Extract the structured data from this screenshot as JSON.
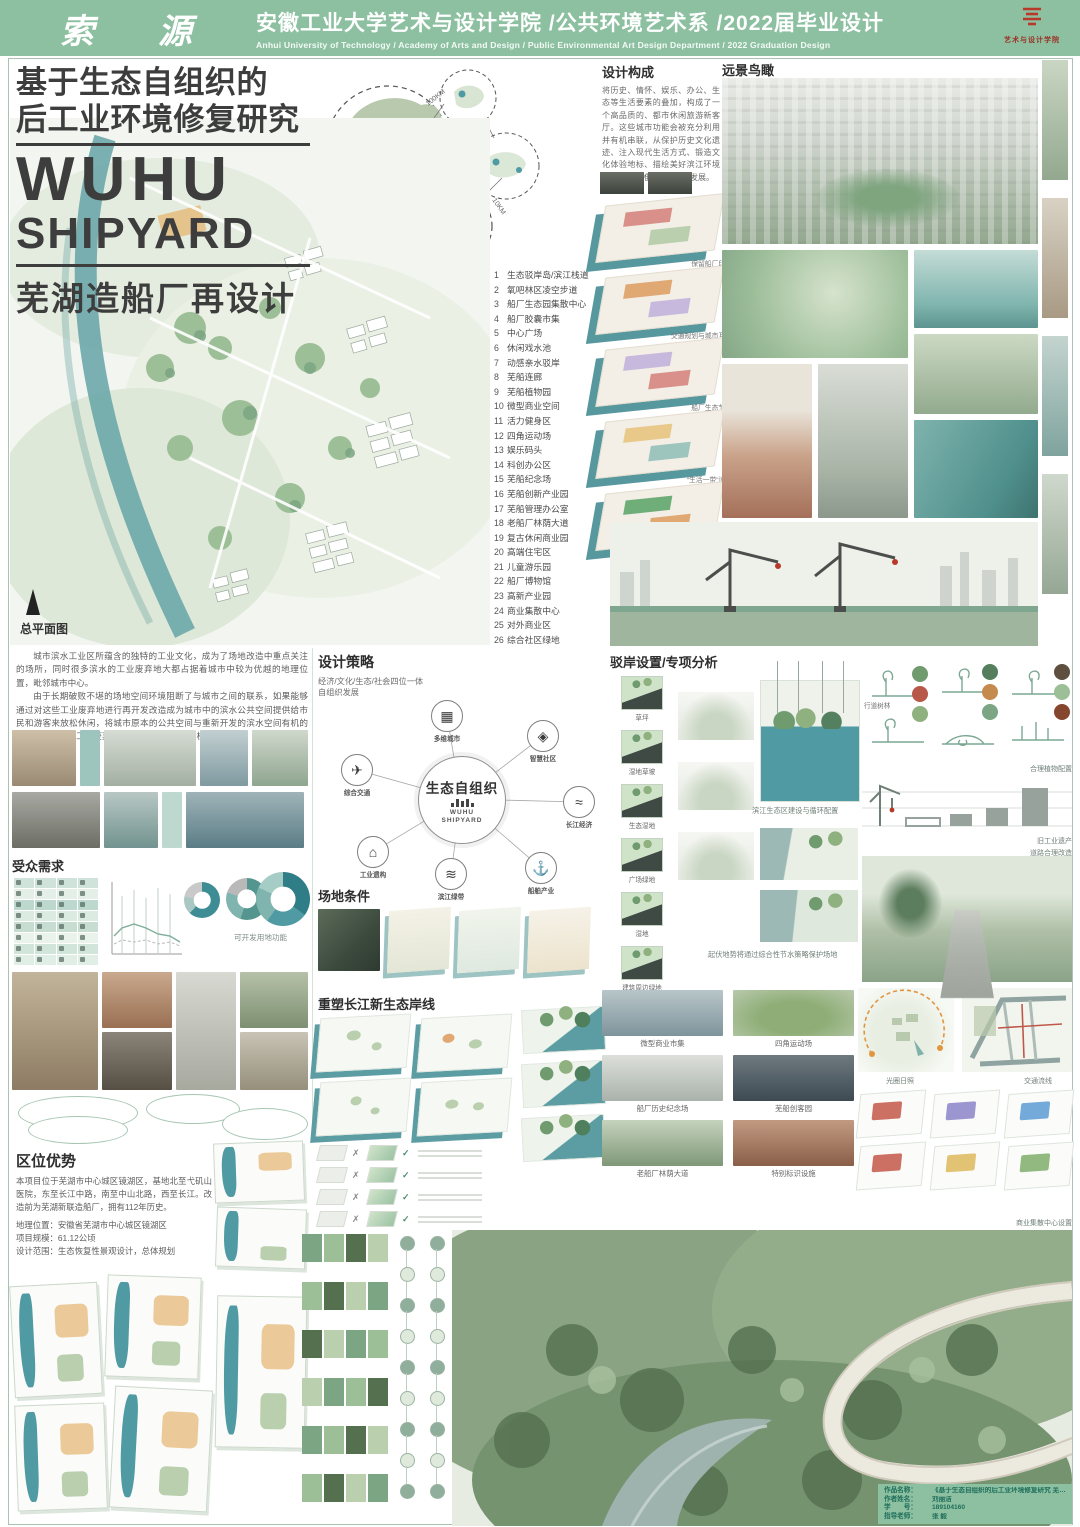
{
  "header": {
    "calligraphy": "索 源",
    "title_cn": "安徽工业大学艺术与设计学院 /公共环境艺术系 /2022届毕业设计",
    "title_en": "Anhui University of Technology / Academy of Arts and Design / Public Environmental Art Design Department / 2022 Graduation Design",
    "logo_text": "艺术与设计学院"
  },
  "title_block": {
    "cn_line1": "基于生态自组织的",
    "cn_line2": "后工业环境修复研究",
    "en_line1": "WUHU",
    "en_line2": "SHIPYARD",
    "sub": "芜湖造船厂再设计"
  },
  "master_plan": {
    "label": "总平面图"
  },
  "mid_maps": {
    "d1": "100KM",
    "d2": "10KM"
  },
  "legend": {
    "items": [
      "生态驳岸岛/滨江栈道",
      "氧吧林区凌空步道",
      "船厂生态园集散中心",
      "船厂胶囊市集",
      "中心广场",
      "休闲戏水池",
      "动感亲水驳岸",
      "芜船连廊",
      "芜船植物园",
      "微型商业空间",
      "活力健身区",
      "四角运动场",
      "娱乐码头",
      "科创办公区",
      "芜船纪念场",
      "芜船创新产业园",
      "芜船管理办公室",
      "老船厂林荫大道",
      "复古休闲商业园",
      "高端住宅区",
      "儿童游乐园",
      "船厂博物馆",
      "高新产业园",
      "商业集散中心",
      "对外商业区",
      "综合社区绿地"
    ]
  },
  "design_comp": {
    "title": "设计构成",
    "body": "将历史、情怀、娱乐、办公、生态等生活要素的叠加，构成了一个高品质的、都市休闲旅游新客厅。这些城市功能会被充分利用并有机串联，从保护历史文化遗迹、注入现代生活方式、锻造文化体验地标、描绘美好滨江环境多方出发，推进城市升级发展。"
  },
  "aerial": {
    "title": "远景鸟瞰"
  },
  "intro": {
    "p1": "城市滨水工业区所蕴含的独特的工业文化，成为了场地改造中重点关注的场所，同时很多滨水的工业废弃地大都占据着城市中较为优越的地理位置，毗邻城市中心。",
    "p2": "由于长期破败不堪的场地空间环境阻断了与城市之间的联系，如果能够通过对这些工业废弃地进行再开发改造成为城市中的滨水公共空间提供给市民和游客来放松休闲，将城市原本的公共空间与重新开发的滨水空间有机的结合，将是滨水工业废弃地景观空间开发新的契机和突破点。"
  },
  "audience": {
    "title": "受众需求",
    "caption": "可开发用地功能"
  },
  "strategy": {
    "title": "设计策略",
    "subtitle1": "经济/文化/生态/社会四位一体",
    "subtitle2": "自组织发展",
    "center": "生态自组织",
    "center_sub1": "WUHU",
    "center_sub2": "SHIPYARD",
    "nodes": [
      {
        "label": "多维城市",
        "icon": "city-icon",
        "glyph": "▦"
      },
      {
        "label": "智慧社区",
        "icon": "smart-community-icon",
        "glyph": "◈"
      },
      {
        "label": "长江经济",
        "icon": "river-economy-icon",
        "glyph": "≈"
      },
      {
        "label": "船舶产业",
        "icon": "ship-industry-icon",
        "glyph": "⚓"
      },
      {
        "label": "滨江绿带",
        "icon": "greenbelt-icon",
        "glyph": "≋"
      },
      {
        "label": "工业遗构",
        "icon": "industrial-heritage-icon",
        "glyph": "⌂"
      },
      {
        "label": "综合交通",
        "icon": "transport-icon",
        "glyph": "✈"
      }
    ]
  },
  "site_cond": {
    "title": "场地条件"
  },
  "reshape": {
    "title": "重塑长江新生态岸线",
    "check": "✓",
    "cross": "✗"
  },
  "zoning": {
    "captions": [
      "保留船厂印记",
      "交通规划与城市互通",
      "船厂生态节点",
      "“生活一带”设计",
      "完善的蓝绿网络"
    ]
  },
  "revetment": {
    "title": "驳岸设置/专项分析",
    "axon_labels": [
      "草坪",
      "湿地草坡",
      "生态湿地",
      "广场绿地",
      "湿地",
      "建筑周边绿地"
    ],
    "caption1": "滨江生态区建设与循环配置",
    "caption2": "起伏地势将通过综合性节水策略保护场地"
  },
  "photo_grid": {
    "captions": [
      "微型商业市集",
      "四角运动场",
      "船厂历史纪念场",
      "芜船创客园",
      "老船厂林荫大道",
      "特别标识设施"
    ]
  },
  "plantings": {
    "street_tree_label": "行道树林",
    "caption1": "合理植物配置",
    "caption2": "旧工业遗产",
    "caption3": "道路合理改造"
  },
  "br_diagrams": {
    "map1_caption": "光圈日照",
    "map2_caption": "交通流线",
    "axon_caption": "商业集散中心设置"
  },
  "location": {
    "title": "区位优势",
    "body": "本项目位于芜湖市中心城区镜湖区，基地北至弋矶山医院，东至长江中路，南至中山北路，西至长江。改造前为芜湖新联造船厂，拥有112年历史。",
    "line1": "地理位置：安徽省芜湖市中心城区镜湖区",
    "line2": "项目规模：61.12公顷",
    "line3": "设计范围：生态恢复性景观设计，总体规划"
  },
  "info_box": {
    "rows": [
      {
        "label": "作品名称：",
        "value": "《基于生态自组织的后工业环境修复研究 芜湖造船厂再设计》"
      },
      {
        "label": "作者姓名：",
        "value": "刘丽洁"
      },
      {
        "label": "学　　号：",
        "value": "189104160"
      },
      {
        "label": "指导老师：",
        "value": "张 毅"
      }
    ]
  }
}
